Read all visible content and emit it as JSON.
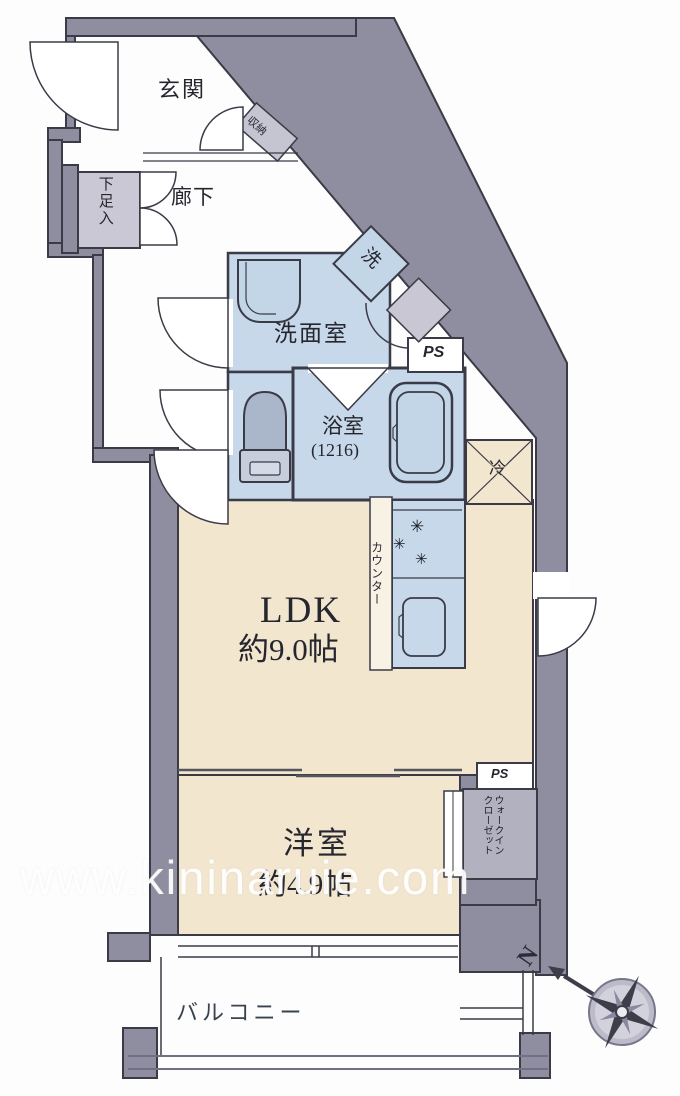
{
  "floorplan": {
    "rooms": {
      "genkan": "玄関",
      "shuno": "収納",
      "gesokuire": "下足入",
      "rouka": "廊下",
      "senmenshitsu": "洗面室",
      "sentaku": "洗",
      "ps": "PS",
      "yokushitsu": "浴室",
      "yokushitsu_size": "(1216)",
      "reizouko": "冷",
      "counter": "カウンター",
      "ldk": "LDK",
      "ldk_size": "約9.0帖",
      "youshitsu": "洋室",
      "youshitsu_size": "約4.9帖",
      "wic_line1": "ウォークイン",
      "wic_line2": "クローゼット",
      "balcony": "バルコニー"
    },
    "compass": {
      "north_label": "N"
    },
    "watermark": "www.kininaruie.com",
    "colors": {
      "wall_gray": "#8f8ea0",
      "wet_blue": "#c6d8e9",
      "room_beige": "#f3e6cf",
      "closet_gray": "#b2b1bf",
      "line_dark": "#3b3b47"
    }
  }
}
